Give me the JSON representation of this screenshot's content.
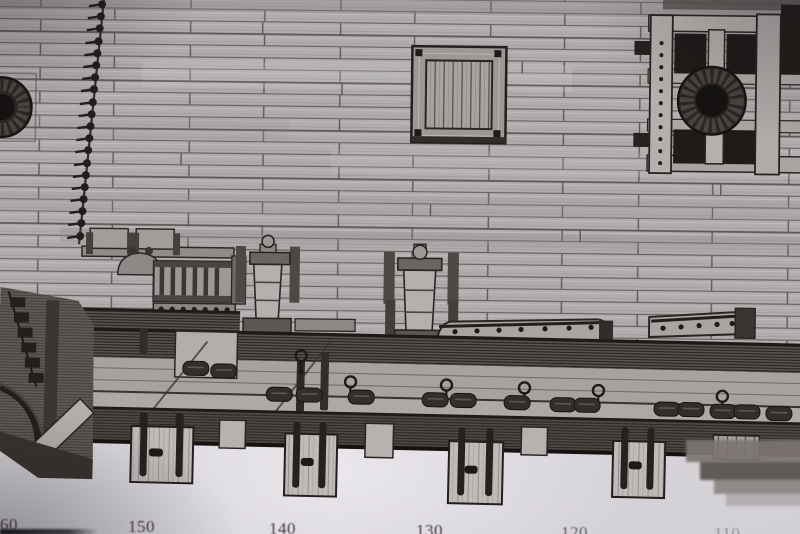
{
  "colors": {
    "paper": "#d8d5da",
    "ink": "#29231f"
  },
  "scale": {
    "labels": [
      "60",
      "150",
      "140",
      "130",
      "120",
      "110"
    ]
  }
}
